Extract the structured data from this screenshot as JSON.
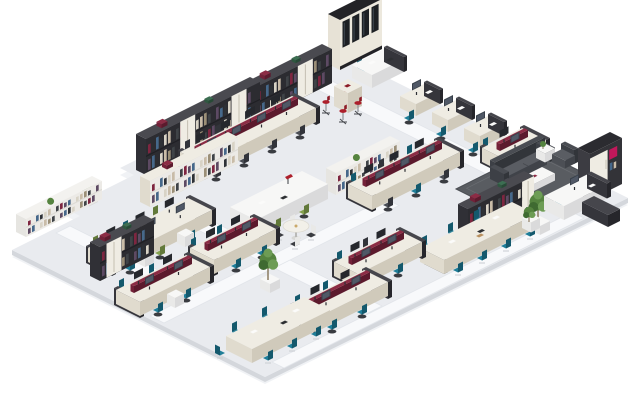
{
  "meta": {
    "title": "Isometric open-plan office floor illustration",
    "description": "3D isometric rendering of an office floor plate with desk clusters, bookshelves, plants, meeting tables, cafe stools and an executive lounge zone. No visible text."
  },
  "scene": {
    "canvas": {
      "w": 640,
      "h": 400
    },
    "colors": {
      "floorTop": "#e9ebef",
      "floorSide": "#d4d7dc",
      "floorShadow": "#f0f2f5",
      "walkway": "#f8f9fb",
      "walkwayEdge": "#e2e5ea",
      "whiteBox": [
        "#f7f7f6",
        "#e9e9e8",
        "#dadadb"
      ],
      "creamBox": [
        "#efece3",
        "#e0dbce",
        "#d0cabb"
      ],
      "darkBox": [
        "#46464c",
        "#35353b",
        "#26262b"
      ],
      "maroonBox": [
        "#8c2c45",
        "#732138",
        "#5c1a2d"
      ],
      "shelfDark": [
        "#4a4a50",
        "#303036",
        "#2c2c31"
      ],
      "shelfLight": [
        "#f3f2ef",
        "#e6e5e1",
        "#efeeea"
      ],
      "sofa": [
        "#5a5d63",
        "#4c4f55",
        "#404349"
      ],
      "sofaDark": [
        "#4a4d53",
        "#3d4046",
        "#32353a"
      ],
      "rug": "#595c61",
      "rugBorder": "#4b4e53",
      "accentMagenta": "#c2185b",
      "accentRed": "#ad1f2b",
      "chairTeal": "#1f7e98",
      "chairDark": "#4a4d54",
      "chairGreen": "#84a14e",
      "foliage": [
        "#55833f",
        "#3f6a31",
        "#6d9c55"
      ],
      "trunk": "#8b7b60",
      "books": [
        "#7e2640",
        "#c9bca8",
        "#46688a",
        "#3f4347",
        "#d8d3c6",
        "#5d4a63",
        "#9b8f77",
        "#2e3136"
      ]
    },
    "floor": {
      "outline": [
        [
          12,
          250
        ],
        [
          80,
          216
        ],
        [
          66,
          209
        ],
        [
          134,
          175
        ],
        [
          120,
          168
        ],
        [
          344,
          56
        ],
        [
          628,
          198
        ],
        [
          265,
          377
        ]
      ]
    },
    "walkways": [
      {
        "edge": [
          [
            302,
            82
          ],
          [
            318,
            74
          ]
        ],
        "dir": "se",
        "len": 268
      },
      {
        "edge": [
          [
            254,
            106
          ],
          [
            270,
            98
          ]
        ],
        "dir": "se",
        "len": 40
      },
      {
        "edge": [
          [
            170,
            216
          ],
          [
            186,
            208
          ]
        ],
        "dir": "se",
        "len": 196
      },
      {
        "edge": [
          [
            56,
            233
          ],
          [
            70,
            226
          ]
        ],
        "dir": "se",
        "len": 92
      },
      {
        "edge": [
          [
            150,
            316
          ],
          [
            164,
            323
          ]
        ],
        "dir": "ne",
        "len": 235
      },
      {
        "edge": [
          [
            272,
            362
          ],
          [
            284,
            368
          ]
        ],
        "dir": "ne",
        "len": 300
      }
    ],
    "furniture": [
      {
        "type": "display-case",
        "pos": [
          328,
          64
        ]
      },
      {
        "type": "plant-box",
        "pos": [
          312,
          76
        ]
      },
      {
        "type": "shelf-small-dark",
        "pos": [
          294,
          84
        ]
      },
      {
        "type": "shelf-dark",
        "pos": [
          246,
          116
        ],
        "len": 76,
        "h": 34,
        "cream": [
          0.55
        ]
      },
      {
        "type": "desk-l",
        "pos": [
          352,
          78
        ]
      },
      {
        "type": "single-desk",
        "pos": [
          400,
          108
        ]
      },
      {
        "type": "single-desk",
        "pos": [
          432,
          124
        ]
      },
      {
        "type": "single-desk",
        "pos": [
          464,
          140
        ]
      },
      {
        "type": "bench-cluster",
        "pos": [
          482,
          162
        ],
        "len": 40,
        "mon": 2,
        "scr": true,
        "chairs": [
          [
            12,
            "nw",
            "teal"
          ],
          [
            20,
            "se",
            "teal"
          ]
        ]
      },
      {
        "type": "stool-table",
        "pos": [
          334,
          106
        ]
      },
      {
        "type": "shelf-dark",
        "pos": [
          136,
          170
        ],
        "len": 114,
        "h": 36,
        "cream": [
          0.3,
          0.75
        ]
      },
      {
        "type": "plant-box",
        "pos": [
          240,
          150
        ]
      },
      {
        "type": "bench-cluster",
        "pos": [
          180,
          166
        ],
        "len": 112,
        "mon": 8,
        "scr": true,
        "chairs": [
          [
            16,
            "nw",
            "dark"
          ],
          [
            46,
            "nw",
            "dark"
          ],
          [
            76,
            "nw",
            "dark"
          ],
          [
            102,
            "nw",
            "dark"
          ],
          [
            6,
            "se",
            "dark"
          ],
          [
            34,
            "se",
            "dark"
          ],
          [
            62,
            "se",
            "dark"
          ],
          [
            90,
            "se",
            "dark"
          ]
        ]
      },
      {
        "type": "shelf-cream",
        "pos": [
          140,
          202
        ],
        "len": 88,
        "h": 26
      },
      {
        "type": "plant-box",
        "pos": [
          80,
          202
        ]
      },
      {
        "type": "shelf-white",
        "pos": [
          326,
          190
        ],
        "len": 64,
        "h": 22
      },
      {
        "type": "bench-cluster",
        "pos": [
          348,
          198
        ],
        "len": 88,
        "mon": 6,
        "scr": true,
        "chairs": [
          [
            14,
            "nw",
            "teal"
          ],
          [
            42,
            "nw",
            "dark"
          ],
          [
            70,
            "nw",
            "teal"
          ],
          [
            10,
            "se",
            "dark"
          ],
          [
            38,
            "se",
            "teal"
          ],
          [
            66,
            "se",
            "dark"
          ]
        ]
      },
      {
        "type": "table-desk",
        "pos": [
          230,
          222
        ],
        "len": 72
      },
      {
        "type": "round-table",
        "pos": [
          296,
          238
        ]
      },
      {
        "type": "shelf-white",
        "pos": [
          16,
          232
        ],
        "len": 76,
        "h": 18
      },
      {
        "type": "bench-cluster",
        "pos": [
          88,
          262
        ],
        "len": 100,
        "mon": 6,
        "scr": false,
        "chairs": [
          [
            16,
            "nw",
            "green"
          ],
          [
            46,
            "nw",
            "teal"
          ],
          [
            76,
            "nw",
            "green"
          ],
          [
            12,
            "se",
            "teal"
          ],
          [
            42,
            "se",
            "green"
          ],
          [
            72,
            "se",
            "teal"
          ]
        ],
        "cab": [
          24,
          64
        ]
      },
      {
        "type": "shelf-dark",
        "pos": [
          90,
          276
        ],
        "len": 54,
        "h": 34,
        "cream": [
          0.12
        ]
      },
      {
        "type": "bench-cluster",
        "pos": [
          190,
          262
        ],
        "len": 62,
        "mon": 4,
        "scr": true,
        "chairs": [
          [
            12,
            "nw",
            "teal"
          ],
          [
            38,
            "nw",
            "teal"
          ],
          [
            16,
            "se",
            "teal"
          ],
          [
            42,
            "se",
            "teal"
          ]
        ]
      },
      {
        "type": "rug",
        "pos": [
          526,
          184
        ]
      },
      {
        "type": "sofa",
        "pos": [
          490,
          178
        ],
        "len": 50
      },
      {
        "type": "side-table",
        "pos": [
          536,
          158
        ]
      },
      {
        "type": "armchair",
        "pos": [
          552,
          162
        ],
        "face": "sw"
      },
      {
        "type": "coffee-table",
        "pos": [
          518,
          186
        ]
      },
      {
        "type": "armchair",
        "pos": [
          504,
          194
        ],
        "face": "ne"
      },
      {
        "type": "tall-cabinet",
        "pos": [
          578,
          194
        ]
      },
      {
        "type": "shelf-dark",
        "pos": [
          458,
          238
        ],
        "len": 66,
        "h": 34,
        "cream": [
          0.82
        ]
      },
      {
        "type": "tree",
        "pos": [
          530,
          230
        ]
      },
      {
        "type": "conf-table",
        "pos": [
          420,
          262
        ],
        "len": 92
      },
      {
        "type": "exec-desk",
        "pos": [
          544,
          210
        ]
      },
      {
        "type": "plant-box",
        "pos": [
          522,
          228
        ]
      },
      {
        "type": "bench-cluster",
        "pos": [
          334,
          276
        ],
        "len": 64,
        "mon": 4,
        "scr": true,
        "chairs": [
          [
            14,
            "nw",
            "teal"
          ],
          [
            40,
            "nw",
            "dark"
          ],
          [
            8,
            "se",
            "teal"
          ],
          [
            34,
            "se",
            "teal"
          ]
        ]
      },
      {
        "type": "tree",
        "pos": [
          260,
          288
        ]
      },
      {
        "type": "bench-cluster",
        "pos": [
          292,
          320
        ],
        "len": 72,
        "mon": 4,
        "scr": true,
        "chairs": [
          [
            14,
            "nw",
            "teal"
          ],
          [
            42,
            "nw",
            "teal"
          ],
          [
            10,
            "se",
            "teal"
          ],
          [
            40,
            "se",
            "teal"
          ]
        ]
      },
      {
        "type": "bench-cluster",
        "pos": [
          116,
          304
        ],
        "len": 70,
        "mon": 4,
        "scr": true,
        "chairs": [
          [
            14,
            "nw",
            "teal"
          ],
          [
            44,
            "nw",
            "teal"
          ],
          [
            12,
            "se",
            "teal"
          ],
          [
            40,
            "se",
            "teal"
          ]
        ],
        "cab": [
          26
        ]
      },
      {
        "type": "meet-table",
        "pos": [
          226,
          350
        ],
        "len": 78
      }
    ]
  }
}
